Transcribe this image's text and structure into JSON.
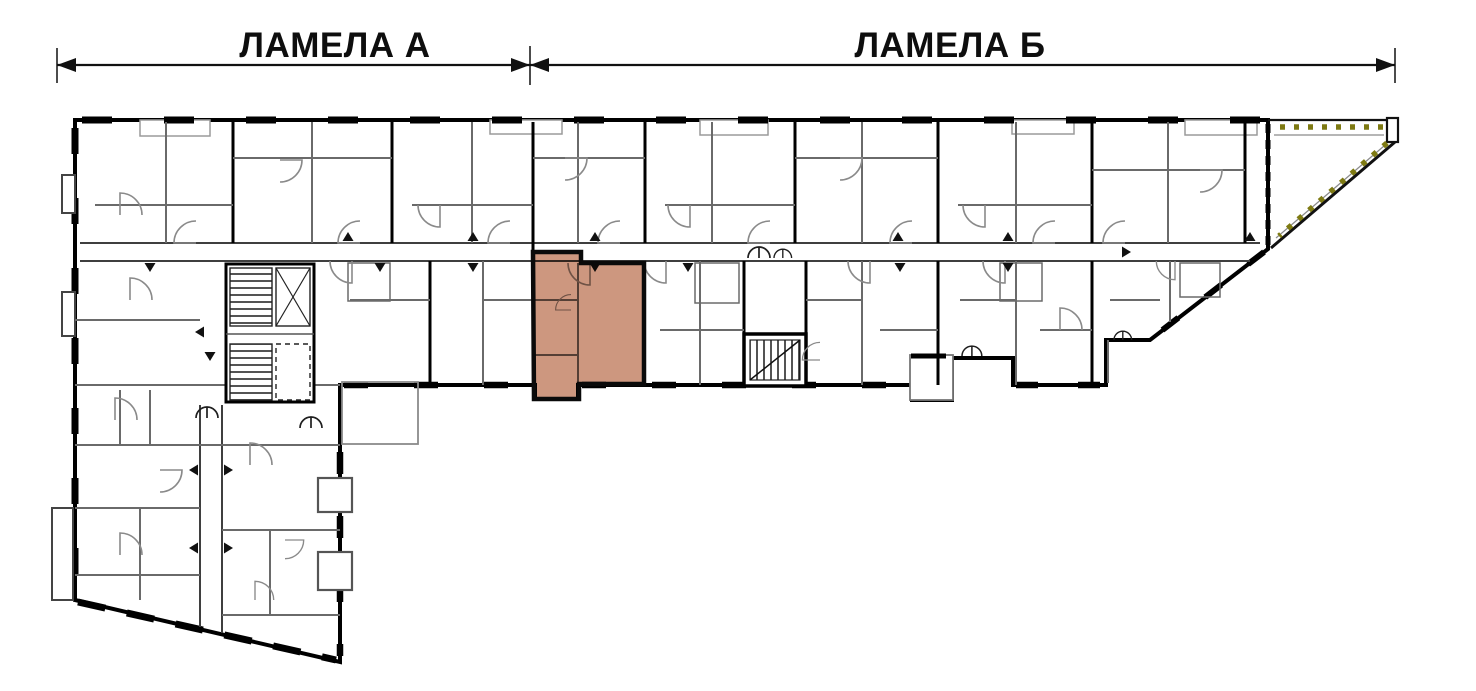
{
  "sections": {
    "a_label": "ЛАМЕЛА А",
    "b_label": "ЛАМЕЛА  Б"
  },
  "highlight": {
    "name": "selected-apartment",
    "fill": "#c98e74",
    "outline": "#0a0a0a"
  },
  "colors": {
    "wall": "#000000",
    "partition": "#6a6a6a",
    "corridor": "#3f3f3f",
    "hedge": "#7e7a12",
    "dimension": "#111111"
  }
}
